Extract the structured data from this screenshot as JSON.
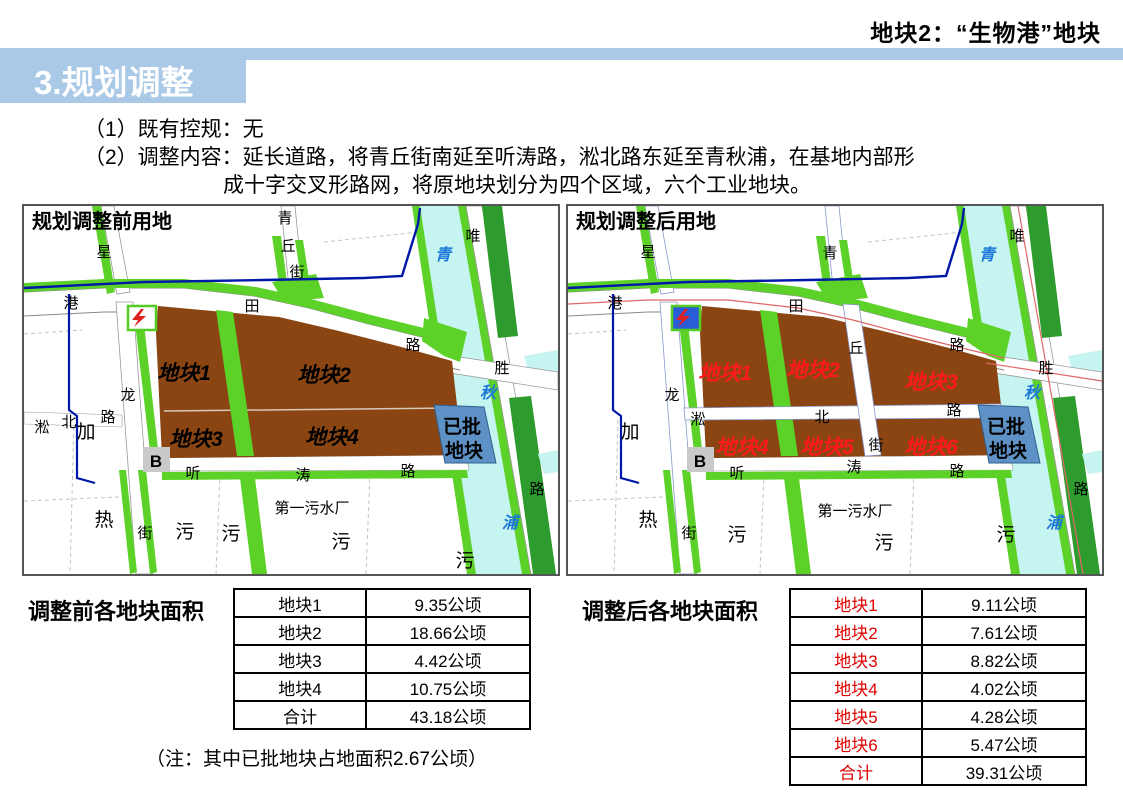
{
  "page": {
    "slide_tag": "地块2：“生物港”地块"
  },
  "title_bar": {
    "title": "3.规划调整"
  },
  "intro": {
    "line1": "（1）既有控规：无",
    "line2": "（2）调整内容：延长道路，将青丘街南延至听涛路，淞北路东延至青秋浦，在基地内部形",
    "line3": "成十字交叉形路网，将原地块划分为四个区域，六个工业地块。"
  },
  "maps": {
    "before": {
      "title": "规划调整前用地",
      "plots": {
        "p1": "地块1",
        "p2": "地块2",
        "p3": "地块3",
        "p4": "地块4"
      }
    },
    "after": {
      "title": "规划调整后用地",
      "plots": {
        "p1": "地块1",
        "p2": "地块2",
        "p3": "地块3",
        "p4": "地块4",
        "p5": "地块5",
        "p6": "地块6"
      }
    },
    "approved": {
      "line1": "已批",
      "line2": "地块"
    },
    "glyphs": {
      "xing": "星",
      "qing_st": "青",
      "qiu_st": "丘",
      "jie_st": "街",
      "wei": "唯",
      "gang": "港",
      "tian": "田",
      "lu": "路",
      "river_qing": "青",
      "river_qiu": "秋",
      "river_pu": "浦",
      "sheng": "胜",
      "long": "龙",
      "song": "淞",
      "bei": "北",
      "jia": "加",
      "b": "B",
      "ting": "听",
      "tao": "涛",
      "re": "热",
      "wu": "污",
      "plant": "第一污水厂"
    }
  },
  "tables": {
    "before": {
      "caption": "调整前各地块面积",
      "rows": [
        {
          "label": "地块1",
          "value": "9.35公顷"
        },
        {
          "label": "地块2",
          "value": "18.66公顷"
        },
        {
          "label": "地块3",
          "value": "4.42公顷"
        },
        {
          "label": "地块4",
          "value": "10.75公顷"
        },
        {
          "label": "合计",
          "value": "43.18公顷"
        }
      ]
    },
    "after": {
      "caption": "调整后各地块面积",
      "rows": [
        {
          "label": "地块1",
          "value": "9.11公顷"
        },
        {
          "label": "地块2",
          "value": "7.61公顷"
        },
        {
          "label": "地块3",
          "value": "8.82公顷"
        },
        {
          "label": "地块4",
          "value": "4.02公顷"
        },
        {
          "label": "地块5",
          "value": "4.28公顷"
        },
        {
          "label": "地块6",
          "value": "5.47公顷"
        },
        {
          "label": "合计",
          "value": "39.31公顷"
        }
      ]
    }
  },
  "note": "（注：其中已批地块占地面积2.67公顷）",
  "colors": {
    "accent_bar": "#A9C9E6",
    "plot_brown": "#8A4513",
    "green_bright": "#5CD228",
    "green_dark": "#2E9B2E",
    "river_cyan": "#C6F4F0",
    "approved_blue": "#5E92C6",
    "boundary_blue": "#0018A8",
    "plot_label_red": "#FF1A1A",
    "table_label_red": "#E00000"
  }
}
